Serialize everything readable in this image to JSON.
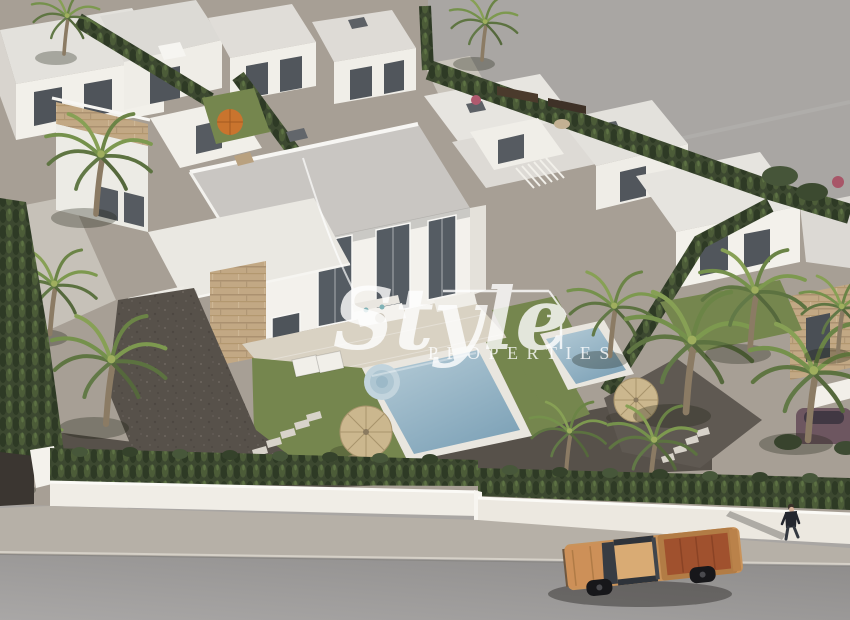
{
  "meta": {
    "description": "Aerial 3D architectural render of a white modern villa development with private pools, cypress hedges and palm trees; a tan pickup truck and a pedestrian on the street below; Style Properties watermark"
  },
  "watermark": {
    "script": "Style",
    "caps": "PROPERTIES",
    "color": "#ffffff",
    "opacity": "0.8"
  },
  "palette": {
    "empty_ground": "#a9a6a3",
    "plot_ground": "#a79f95",
    "gravel_dark": "#57514a",
    "lawn_green": "#75864e",
    "hedge_green": "#3a4730",
    "terrace": "#d9d2c3",
    "pool_rim": "#e9e6df",
    "pool_water": "#8fb0c2",
    "stone_clad": "#c2a884",
    "roof_gray": "#c9c6c2",
    "wall_white": "#f3f1ec",
    "glass_dark": "#555c63",
    "perimeter_wall": "#f0ede6",
    "sidewalk": "#b6b0a7",
    "road": "#9a9896",
    "truck_body": "#c9935a",
    "truck_bed": "#a0512e",
    "umbrella_straw": "#cbb78e",
    "umbrella_orange": "#c9742e"
  }
}
